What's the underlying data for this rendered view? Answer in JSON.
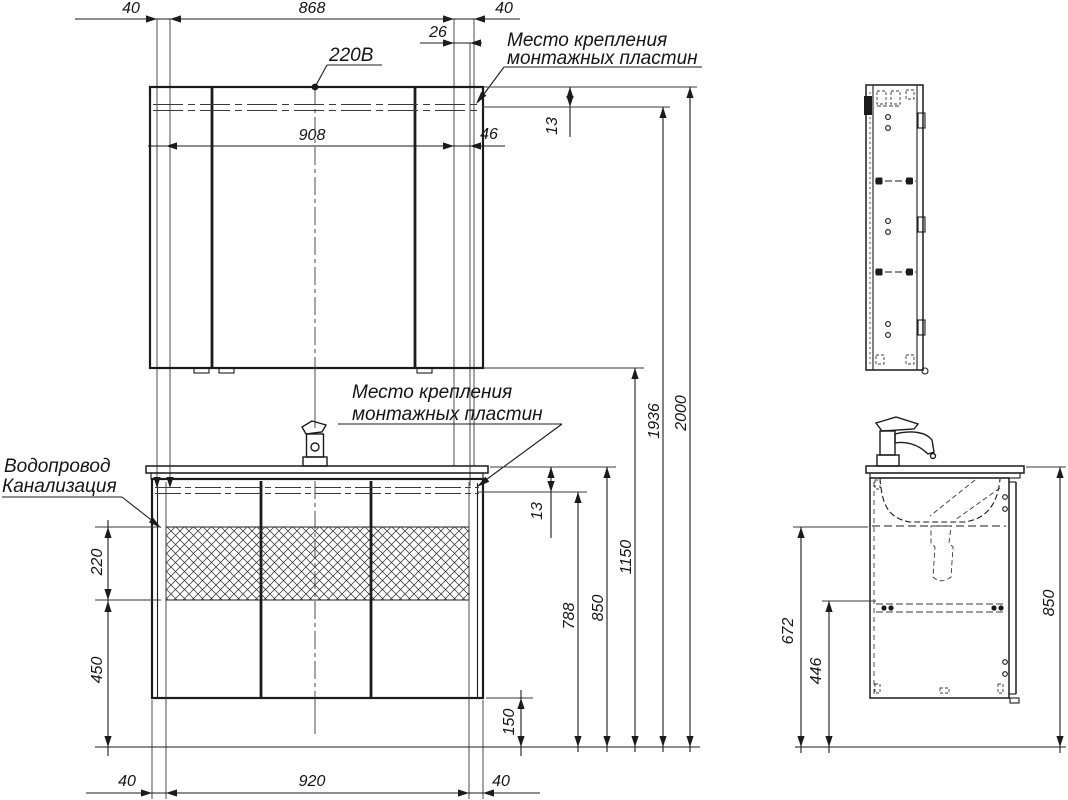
{
  "callouts": {
    "power": "220В",
    "mount_line1": "Место крепления",
    "mount_line2": "монтажных пластин",
    "water": "Водопровод",
    "sewer": "Канализация"
  },
  "dims": {
    "t40l": "40",
    "t868": "868",
    "t40r": "40",
    "t26": "26",
    "m908": "908",
    "m46": "46",
    "m13": "13",
    "v13": "13",
    "r788": "788",
    "r850": "850",
    "r1150": "1150",
    "r1936": "1936",
    "r2000": "2000",
    "l220": "220",
    "l450": "450",
    "b150": "150",
    "b40l": "40",
    "b920": "920",
    "b40r": "40",
    "s672": "672",
    "s446": "446",
    "s850": "850"
  }
}
